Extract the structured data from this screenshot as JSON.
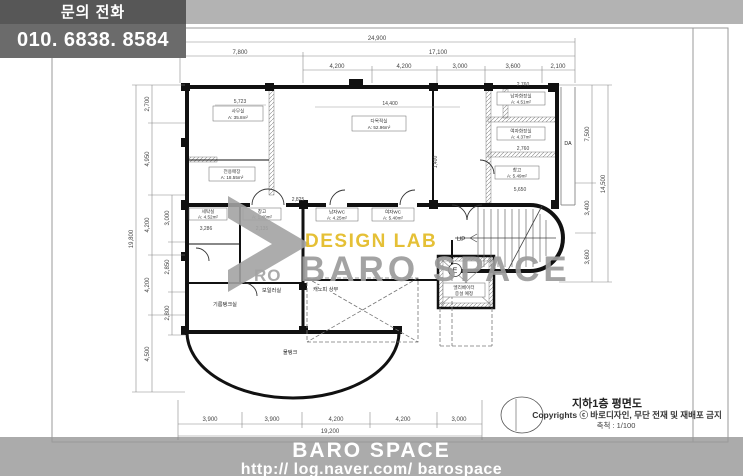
{
  "contact": {
    "label": "문의 전화",
    "number": "010. 6838. 8584"
  },
  "footer": {
    "brand": "BARO SPACE",
    "url": "http:// log.naver.com/ barospace"
  },
  "watermark": {
    "design_lab": "DESIGN LAB",
    "brand": "BARO SPACE",
    "logo_ro": "RO"
  },
  "titleblock": {
    "title": "지하1층 평면도",
    "copyright": "Copyrights ⓒ 바로디자인, 무단 전재 및 재배포 금지",
    "scale": "축척 : 1/100"
  },
  "dims": {
    "top": {
      "overall": "24,900",
      "mid": [
        "7,800",
        "17,100"
      ],
      "inner": [
        "4,200",
        "4,200",
        "3,000",
        "3,600",
        "2,100"
      ]
    },
    "bottom": {
      "overall": "19,200",
      "inner": [
        "3,900",
        "3,900",
        "4,200",
        "4,200",
        "3,000"
      ]
    },
    "left": {
      "overall": "19,800",
      "outer": [
        "2,700",
        "4,950",
        "4,200",
        "4,200",
        "4,500"
      ],
      "inner": [
        "3,000",
        "2,850",
        "2,800"
      ]
    },
    "right": {
      "overall": "14,500",
      "inner": [
        "7,500",
        "3,400",
        "3,600"
      ]
    },
    "detail": [
      "5,723",
      "14,400",
      "2,760",
      "2,760",
      "5,650",
      "3,286",
      "2,825",
      "2,135",
      "1,400"
    ]
  },
  "plan": {
    "da": "DA",
    "up": "UP",
    "elevator_mark": "E",
    "rooms": [
      {
        "name": "사무실",
        "area": "A: 35.8m²"
      },
      {
        "name": "다목적실",
        "area": "A: 52.96m²"
      },
      {
        "name": "남자화장실",
        "area": "A: 4.51m²"
      },
      {
        "name": "여자화장실",
        "area": "A: 4.37m²"
      },
      {
        "name": "창고",
        "area": "A: 5.49m²"
      },
      {
        "name": "전용매장",
        "area": "A: 18.55m²"
      },
      {
        "name": "세탁실",
        "area": "A: 4.52m²"
      },
      {
        "name": "창고",
        "area": "A: 1.40m²"
      },
      {
        "name": "남자WC",
        "area": "A: 4.25m²"
      },
      {
        "name": "여자WC",
        "area": "A: 5.40m²"
      }
    ],
    "annotations": {
      "oil_tank": "기름탱크실",
      "boiler": "보일러실",
      "water_tank": "물탱크",
      "canopy": "캐노피 상부",
      "elev_note_1": "엘리베이터",
      "elev_note_2": "증설 예정"
    }
  },
  "colors": {
    "top_band": "#b3b3b3",
    "contact_top": "#575757",
    "contact_bottom": "#6b6b6b",
    "footer_band": "#ababab",
    "watermark_yellow": "#e4bd2c",
    "watermark_gray": "#9c9c9c",
    "wall": "#111111"
  }
}
